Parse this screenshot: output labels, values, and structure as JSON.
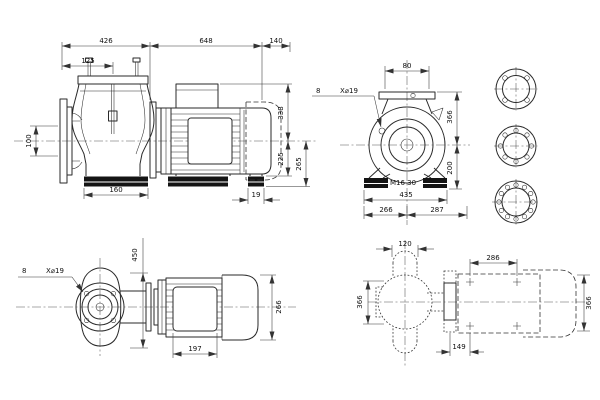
{
  "drawing": {
    "background": "#ffffff",
    "line_color": "#2a2a2a",
    "views": {
      "side_elevation": {
        "dims": {
          "d426": "426",
          "d648": "648",
          "d140": "140",
          "d125": "125",
          "d100": "100",
          "d160": "160",
          "d338": "338",
          "d225": "225",
          "d265": "265",
          "d19": "19"
        }
      },
      "end_view": {
        "dims": {
          "d80": "80",
          "holes_count": "8",
          "holes_spec": "X⌀19",
          "d366": "366",
          "d200": "200",
          "anchor_thread": "M16 30",
          "d435": "435",
          "d266": "266",
          "d287": "287"
        }
      },
      "flange_faces": {
        "top_bolt_holes": 4,
        "middle_bolt_holes": 8,
        "bottom_bolt_holes": 12
      },
      "plan_view": {
        "dims": {
          "d450": "450",
          "holes_count": "8",
          "holes_spec": "X⌀19",
          "d197": "197",
          "d266": "266"
        }
      },
      "foundation_plan": {
        "dims": {
          "d120": "120",
          "d286": "286",
          "d366_left": "366",
          "d366_right": "366",
          "d149": "149"
        }
      }
    }
  }
}
